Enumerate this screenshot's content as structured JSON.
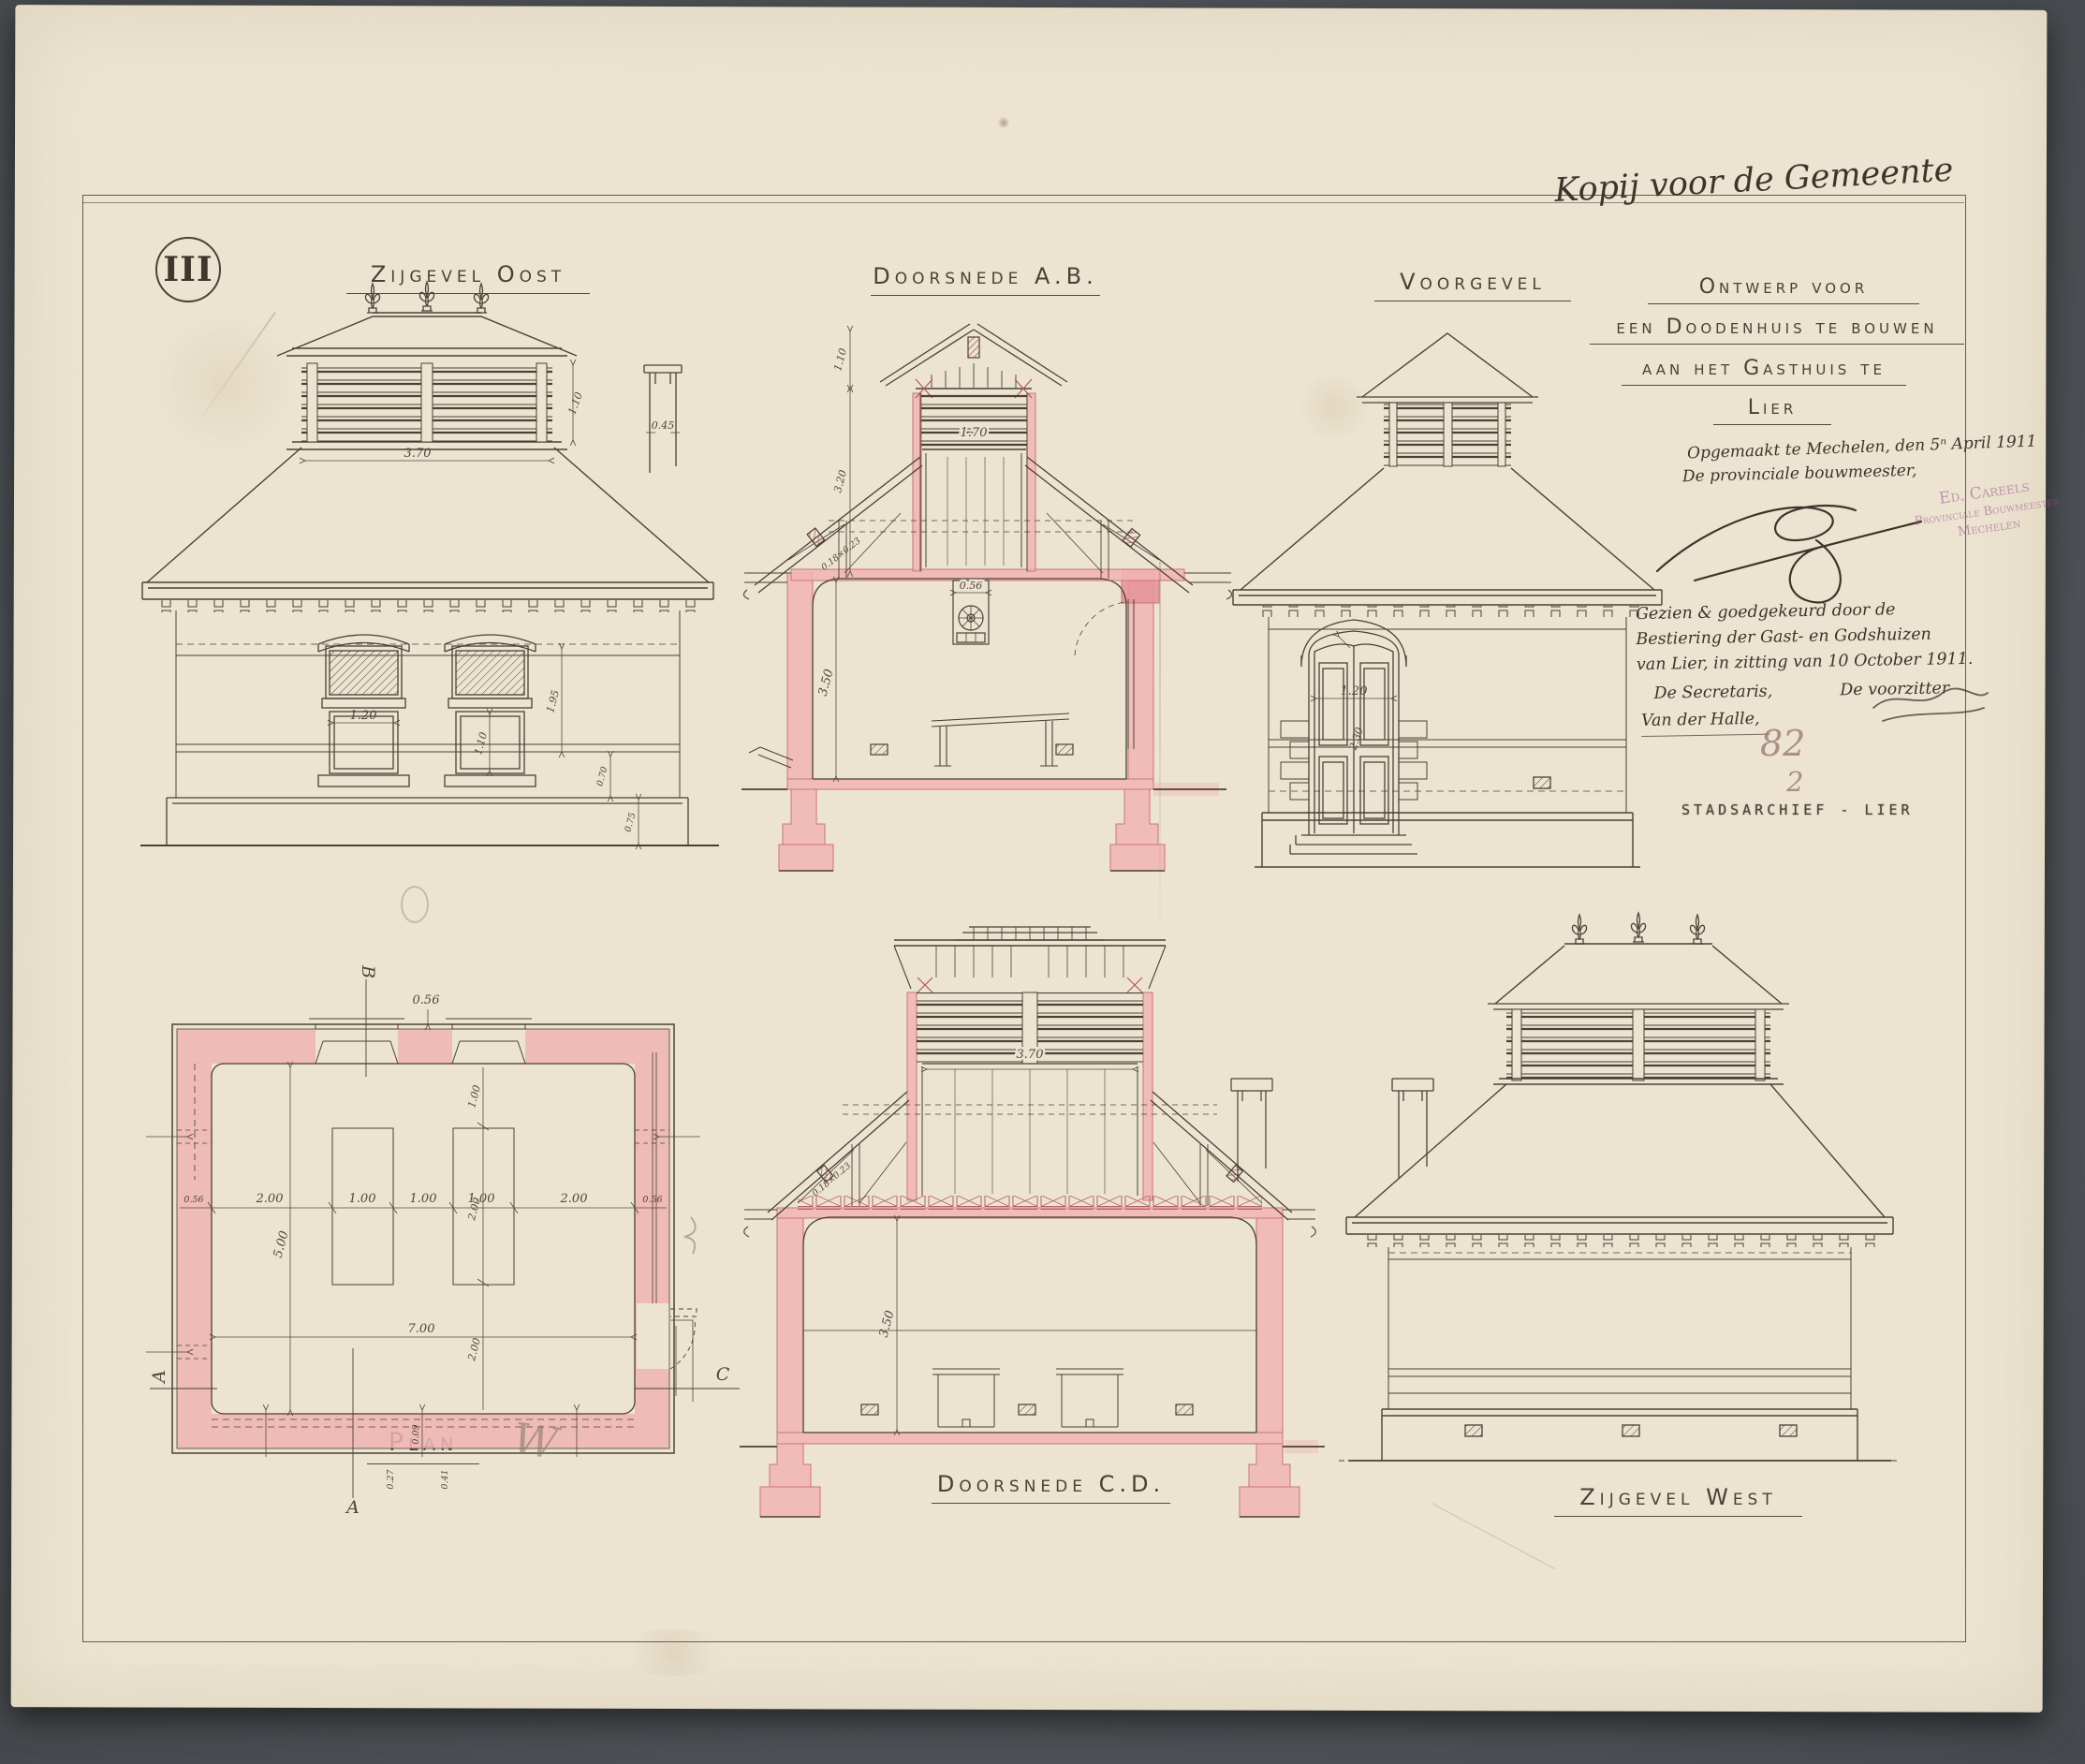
{
  "page": {
    "sheet_number": "III",
    "top_note": "Kopij voor de Gemeente"
  },
  "title_block": {
    "line1": "Ontwerp voor",
    "line2": "een Doodenhuis te bouwen",
    "line3": "aan het Gasthuis te",
    "line4": "Lier"
  },
  "annotations": {
    "made": "Opgemaakt te Mechelen, den 5ⁿ April 1911",
    "role": "De provinciale bouwmeester,",
    "approval_1": "Gezien & goedgekeurd door de",
    "approval_2": "Bestiering der Gast- en Godshuizen",
    "approval_3": "van Lier, in zitting van 10 October 1911.",
    "secretary": "De Secretaris,",
    "chairman": "De voorzitter",
    "secretary_name": "Van der Halle,",
    "pencil_number": "82",
    "pencil_number_2": "2",
    "pencil_w": "W",
    "stamp_line1": "Ed. Careels",
    "stamp_line2": "Provinciale Bouwmeester",
    "stamp_line3": "Mechelen",
    "archive_stamp": "STADSARCHIEF - LIER"
  },
  "drawings": {
    "east": {
      "label": "Zijgevel Oost",
      "dim_lantern_w": "3.70",
      "dim_lantern_h": "1.10",
      "dim_chimney": "0.45",
      "dim_window_w": "1.20",
      "dim_window_h": "1.10",
      "dim_wall": "1.95",
      "dim_frieze": "0.70",
      "dim_plinth": "0.75"
    },
    "section_ab": {
      "label": "Doorsnede A.B.",
      "dim_gable": "1.10",
      "dim_roof": "3.20",
      "dim_shaft": "1.70",
      "dim_vent": "0.56",
      "dim_room": "3.50",
      "dim_rafter": "0.18×0.23"
    },
    "front": {
      "label": "Voorgevel",
      "dim_door_w": "1.20",
      "dim_door_h": "2.30"
    },
    "plan": {
      "label": "Plan",
      "mark_top": "B",
      "mark_bottom": "A",
      "mark_left": "A",
      "mark_right": "C",
      "dim_wall_l": "0.56",
      "dim_wall_r": "0.56",
      "dim_wall_top": "0.56",
      "seg_1": "2.00",
      "seg_2": "1.00",
      "seg_3": "1.00",
      "seg_4": "1.00",
      "seg_5": "2.00",
      "dim_width": "7.00",
      "dim_depth": "5.00",
      "v_1": "1.00",
      "v_2": "2.00",
      "v_3": "2.00",
      "d_1": "0.09",
      "d_2": "0.27",
      "d_3": "0.41"
    },
    "section_cd": {
      "label": "Doorsnede C.D.",
      "dim_shaft": "3.70",
      "dim_room": "3.50",
      "dim_rafter": "0.18×0.23"
    },
    "west": {
      "label": "Zijgevel West"
    }
  }
}
